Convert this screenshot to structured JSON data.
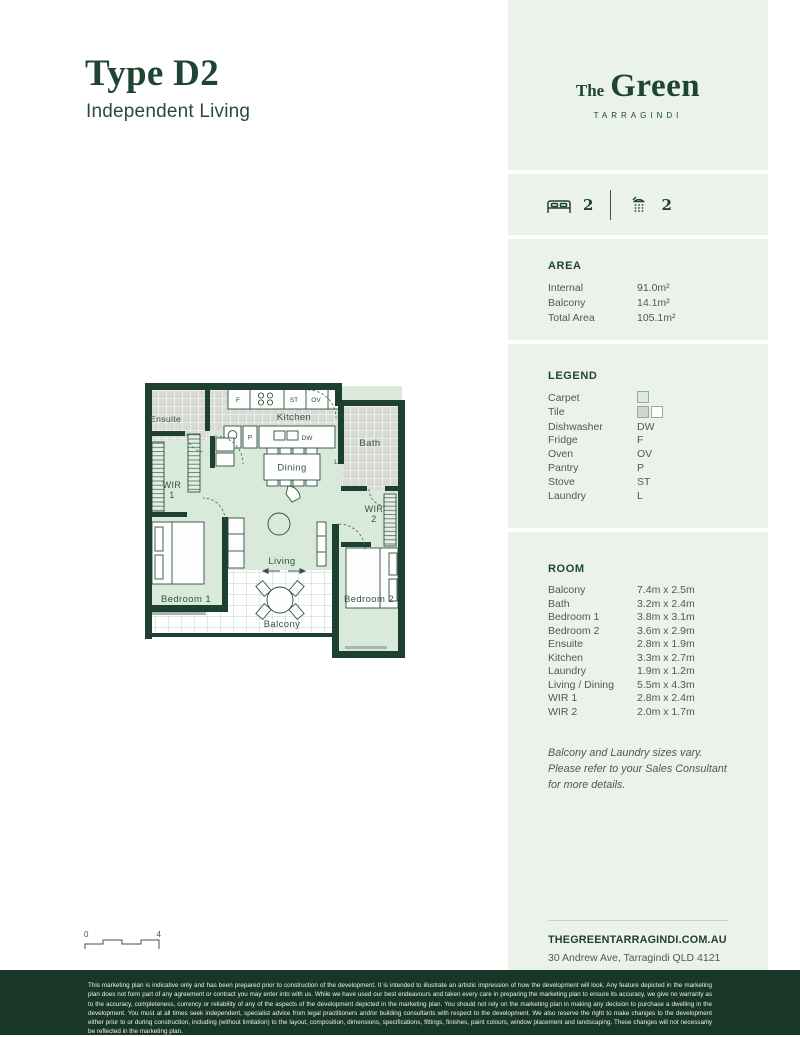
{
  "page": {
    "title": "Type D2",
    "subtitle": "Independent Living"
  },
  "brand": {
    "the": "The",
    "green": "Green",
    "location": "TARRAGINDI"
  },
  "stats": {
    "bedrooms": "2",
    "bathrooms": "2"
  },
  "area": {
    "heading": "AREA",
    "rows": [
      {
        "label": "Internal",
        "value": "91.0m²"
      },
      {
        "label": "Balcony",
        "value": "14.1m²"
      },
      {
        "label": "Total Area",
        "value": "105.1m²"
      }
    ]
  },
  "legend": {
    "heading": "LEGEND",
    "rows": [
      {
        "label": "Carpet",
        "code": ""
      },
      {
        "label": "Tile",
        "code": ""
      },
      {
        "label": "Dishwasher",
        "code": "DW"
      },
      {
        "label": "Fridge",
        "code": "F"
      },
      {
        "label": "Oven",
        "code": "OV"
      },
      {
        "label": "Pantry",
        "code": "P"
      },
      {
        "label": "Stove",
        "code": "ST"
      },
      {
        "label": "Laundry",
        "code": "L"
      }
    ]
  },
  "rooms": {
    "heading": "ROOM",
    "rows": [
      {
        "label": "Balcony",
        "value": "7.4m x 2.5m"
      },
      {
        "label": "Bath",
        "value": "3.2m x 2.4m"
      },
      {
        "label": "Bedroom 1",
        "value": "3.8m x 3.1m"
      },
      {
        "label": "Bedroom 2",
        "value": "3.6m x 2.9m"
      },
      {
        "label": "Ensuite",
        "value": "2.8m x 1.9m"
      },
      {
        "label": "Kitchen",
        "value": "3.3m x 2.7m"
      },
      {
        "label": "Laundry",
        "value": "1.9m x 1.2m"
      },
      {
        "label": "Living / Dining",
        "value": "5.5m x 4.3m"
      },
      {
        "label": "WIR 1",
        "value": "2.8m x 2.4m"
      },
      {
        "label": "WIR 2",
        "value": "2.0m x 1.7m"
      }
    ],
    "note": "Balcony and Laundry sizes vary. Please refer to your Sales Consultant for more details."
  },
  "floorplan": {
    "labels": {
      "ensuite": "Ensuite",
      "kitchen": "Kitchen",
      "bath": "Bath",
      "wir": "WIR",
      "wir1_num": "1",
      "wir2_num": "2",
      "dining": "Dining",
      "living": "Living",
      "bedroom1": "Bedroom 1",
      "bedroom2": "Bedroom 2",
      "balcony": "Balcony"
    },
    "markers": {
      "fridge": "F",
      "stove": "ST",
      "oven": "OV",
      "pantry": "P",
      "dishwasher": "DW",
      "laundry": "L"
    }
  },
  "scalebar": {
    "min": "0",
    "max": "4"
  },
  "contact": {
    "website": "THEGREENTARRAGINDI.COM.AU",
    "address": "30 Andrew Ave, Tarragindi QLD 4121"
  },
  "footer": {
    "disclaimer": "This marketing plan is indicative only and has been prepared prior to construction of the development. It is intended to illustrate an artistic impression of how the development will look. Any feature depicted in the marketing plan does not form part of any agreement or contract you may enter into with us. While we have used our best endeavours and taken every care in preparing the marketing plan to ensure its accuracy, we give no warranty as to the accuracy, completeness, currency or reliability of any of the aspects of the development depicted in the marketing plan. You should not rely on the marketing plan in making any decision to purchase a dwelling in the development. You must at all times seek independent, specialist advice from legal practitioners and/or building consultants with respect to the development. We also reserve the right to make changes to the development either prior to or during construction, including (without limitation) to the layout, composition, dimensions, specifications, fittings, finishes, paint colours, window placement and landscaping. These changes will not necessarily be reflected in the marketing plan."
  },
  "colors": {
    "brand_green": "#1c4132",
    "footer_bg": "#183726",
    "sidebar_bg": "#ebf2eb",
    "carpet": "#d9e9da"
  }
}
